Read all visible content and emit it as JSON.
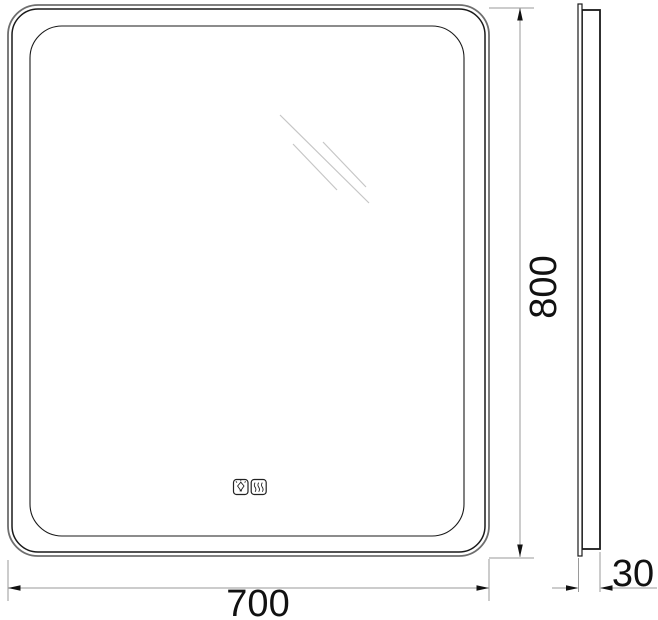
{
  "drawing": {
    "type": "technical-dimension-drawing",
    "subject": "rounded-rectangular LED mirror, front view and side profile",
    "front_view": {
      "width_label": "700",
      "height_label": "800",
      "touch_buttons": [
        {
          "name": "light-sensor",
          "icon": "bulb-icon"
        },
        {
          "name": "antifog-sensor",
          "icon": "heat-waves-icon"
        }
      ]
    },
    "side_view": {
      "depth_label": "30"
    },
    "colors": {
      "outline_black": "#1a1a1a",
      "outer_edge_gray": "#6e6e6e",
      "dimension_line_gray": "#9a9a9a",
      "arrow_fill": "#111111",
      "reflection_gray": "#c6c6c6",
      "text": "#111111",
      "background": "#ffffff"
    }
  }
}
